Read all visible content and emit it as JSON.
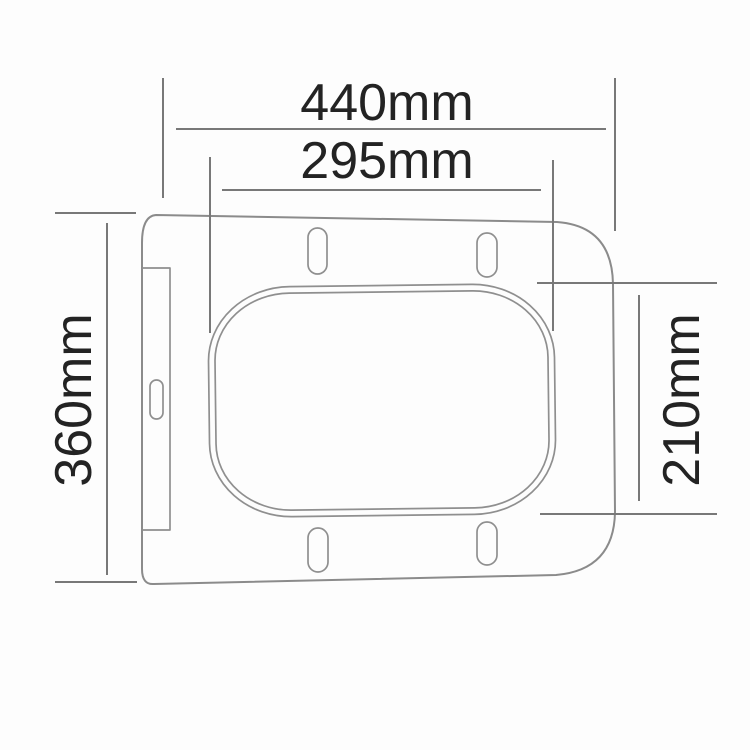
{
  "diagram": {
    "subject": "Square toilet seat top-view dimension drawing",
    "unit": "mm",
    "colors": {
      "outline": "#8b8b8b",
      "dimension_lines": "#787878",
      "label_text": "#232323",
      "background": "#fdfdfd"
    },
    "dimensions": {
      "overall_width": {
        "label": "440mm",
        "value": 440,
        "unit": "mm"
      },
      "opening_width": {
        "label": "295mm",
        "value": 295,
        "unit": "mm"
      },
      "overall_depth": {
        "label": "360mm",
        "value": 360,
        "unit": "mm"
      },
      "opening_depth": {
        "label": "210mm",
        "value": 210,
        "unit": "mm"
      }
    }
  }
}
